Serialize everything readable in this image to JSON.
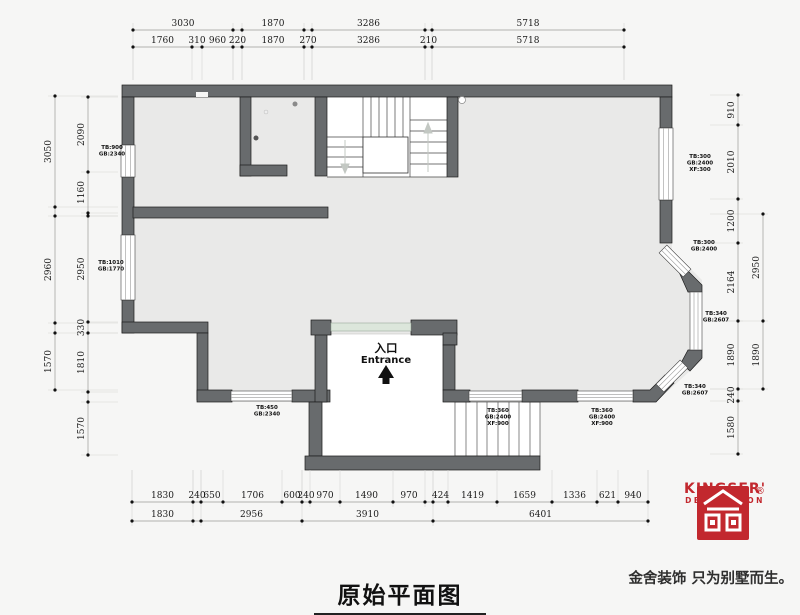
{
  "title": "原始平面图",
  "entrance": {
    "cn": "入口",
    "en": "Entrance"
  },
  "logo": {
    "brand": "KINGSER'",
    "sub": "DECORATION",
    "registered": "®",
    "tagline": "金舍装饰 只为别墅而生。",
    "color": "#c2282e"
  },
  "colors": {
    "background": "#f6f6f5",
    "floor": "#e9e9e8",
    "wall": "#686b6d",
    "door_band": "#dce6db",
    "logo_red": "#c2282e"
  },
  "dimensions": {
    "top_outer": [
      "3030",
      "1870",
      "3286",
      "5718"
    ],
    "top_inner": [
      "1760",
      "310",
      "960",
      "220",
      "1870",
      "270",
      "3286",
      "210",
      "5718"
    ],
    "left_outer": [
      "3050",
      "2960",
      "1570"
    ],
    "left_inner": [
      "2090",
      "1160",
      "2950",
      "330",
      "1810",
      "1570"
    ],
    "right_inner": [
      "910",
      "2010",
      "1200",
      "2164",
      "1890",
      "240",
      "1580"
    ],
    "right_outer": [
      "2950",
      "1890"
    ],
    "bottom_inner": [
      "1830",
      "240",
      "650",
      "1706",
      "600",
      "240",
      "970",
      "1490",
      "970",
      "424",
      "1419",
      "1659",
      "1336",
      "621",
      "940"
    ],
    "bottom_outer": [
      "1830",
      "2956",
      "3910",
      "6401"
    ]
  },
  "window_tags": [
    {
      "lines": [
        "TB:900",
        "GB:2340"
      ]
    },
    {
      "lines": [
        "TB:1010",
        "GB:1770"
      ]
    },
    {
      "lines": [
        "TB:300",
        "GB:2400",
        "XF:300"
      ]
    },
    {
      "lines": [
        "TB:300",
        "GB:2400"
      ]
    },
    {
      "lines": [
        "TB:340",
        "GB:2607"
      ]
    },
    {
      "lines": [
        "TB:340",
        "GB:2607"
      ]
    },
    {
      "lines": [
        "TB:450",
        "GB:2340"
      ]
    },
    {
      "lines": [
        "TB:360",
        "GB:2400",
        "XF:900"
      ]
    },
    {
      "lines": [
        "TB:360",
        "GB:2400",
        "XF:900"
      ]
    }
  ]
}
